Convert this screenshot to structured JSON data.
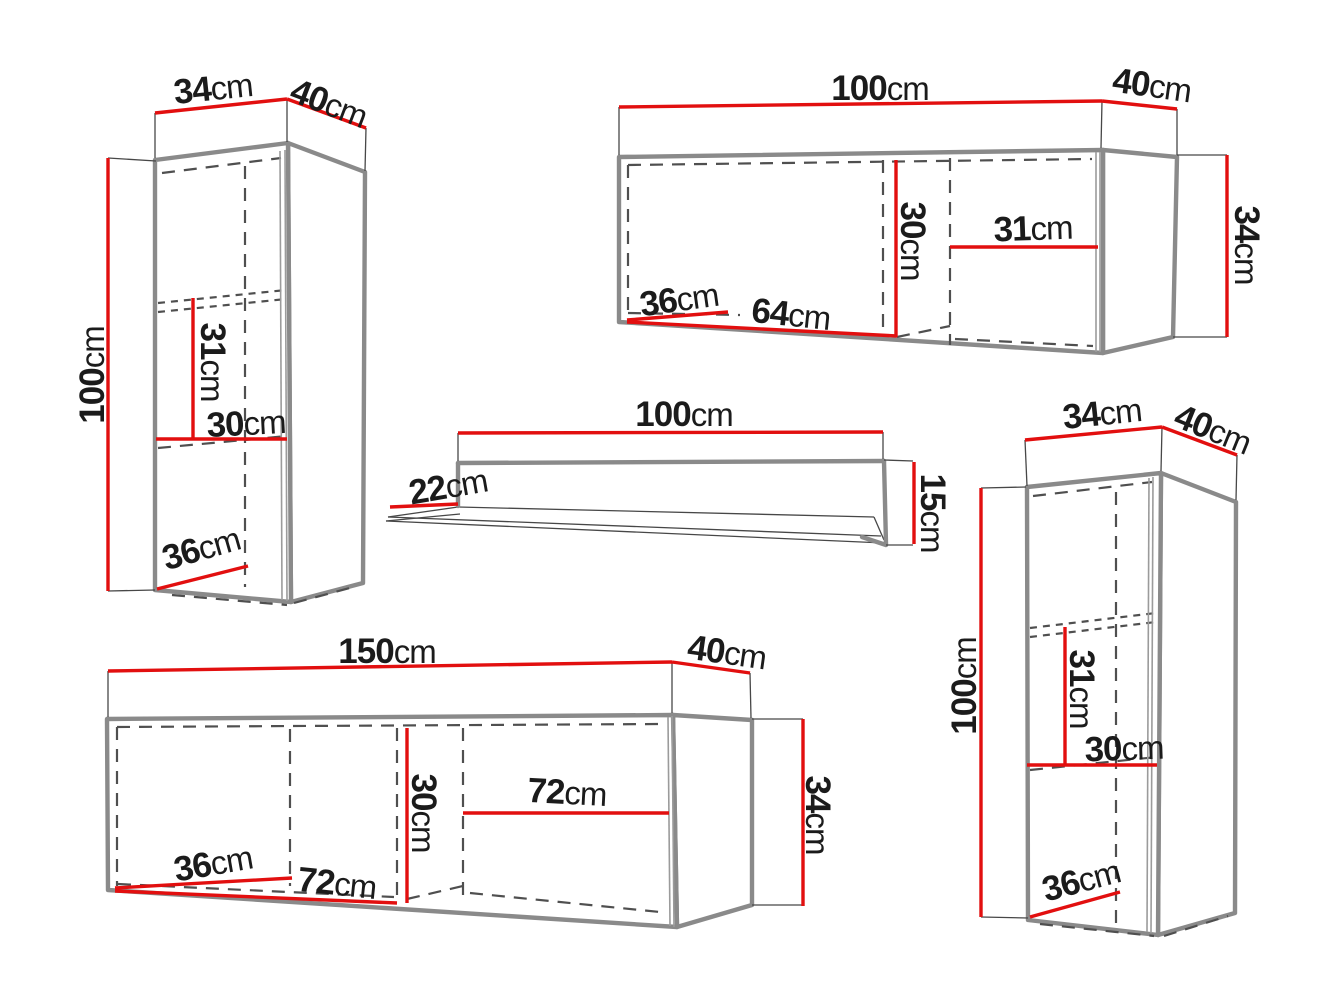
{
  "unit": "cm",
  "colors": {
    "dimension_line": "#e20f0f",
    "body_outline": "#8a8a8a",
    "hidden_edge_dashed": "#4f4f4f",
    "extension_line": "#474747",
    "label_text": "#1b1b1b",
    "background": "#ffffff"
  },
  "pieces": [
    {
      "id": "tall-wall-cabinet-left",
      "labels": {
        "width": {
          "v": "34"
        },
        "depth": {
          "v": "40"
        },
        "height": {
          "v": "100"
        },
        "innerHeight": {
          "v": "31"
        },
        "innerWidth": {
          "v": "30"
        },
        "innerDepth": {
          "v": "36"
        }
      }
    },
    {
      "id": "wide-wall-cabinet-top",
      "labels": {
        "width": {
          "v": "100"
        },
        "depth": {
          "v": "40"
        },
        "height": {
          "v": "34"
        },
        "innerHeight": {
          "v": "30"
        },
        "innerWidth": {
          "v": "31"
        },
        "innerDepth": {
          "v": "36"
        },
        "innerWidth2": {
          "v": "64"
        }
      }
    },
    {
      "id": "wall-shelf",
      "labels": {
        "width": {
          "v": "100"
        },
        "depth": {
          "v": "22"
        },
        "height": {
          "v": "15"
        }
      }
    },
    {
      "id": "wide-wall-cabinet-bottom",
      "labels": {
        "width": {
          "v": "150"
        },
        "depth": {
          "v": "40"
        },
        "height": {
          "v": "34"
        },
        "innerHeight": {
          "v": "30"
        },
        "innerWidth": {
          "v": "72"
        },
        "innerDepth": {
          "v": "36"
        },
        "innerWidth2": {
          "v": "72"
        }
      }
    },
    {
      "id": "tall-wall-cabinet-right",
      "labels": {
        "width": {
          "v": "34"
        },
        "depth": {
          "v": "40"
        },
        "height": {
          "v": "100"
        },
        "innerHeight": {
          "v": "31"
        },
        "innerWidth": {
          "v": "30"
        },
        "innerDepth": {
          "v": "36"
        }
      }
    }
  ]
}
